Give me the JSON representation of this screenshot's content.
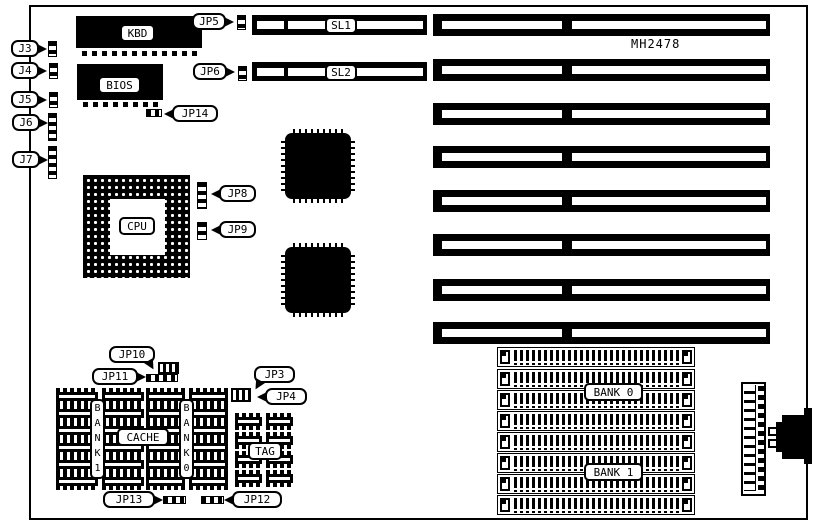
{
  "diagram": {
    "board_id": "MH2478",
    "chips": {
      "kbd": "KBD",
      "bios": "BIOS",
      "cpu": "CPU",
      "cache": "CACHE",
      "tag": "TAG",
      "bank1_vertical": "B\nA\nN\nK\n1",
      "bank0_vertical": "B\nA\nN\nK\n0"
    },
    "slots": {
      "sl1": "SL1",
      "sl2": "SL2",
      "isa_slot_count": 8,
      "simm_socket_count": 8,
      "simm_bank0_label": "BANK 0",
      "simm_bank1_label": "BANK 1"
    },
    "jumpers": {
      "j3": "J3",
      "j4": "J4",
      "j5": "J5",
      "j6": "J6",
      "j7": "J7",
      "jp3": "JP3",
      "jp4": "JP4",
      "jp5": "JP5",
      "jp6": "JP6",
      "jp8": "JP8",
      "jp9": "JP9",
      "jp10": "JP10",
      "jp11": "JP11",
      "jp12": "JP12",
      "jp13": "JP13",
      "jp14": "JP14"
    },
    "colors": {
      "ink": "#000000",
      "paper": "#ffffff"
    }
  }
}
